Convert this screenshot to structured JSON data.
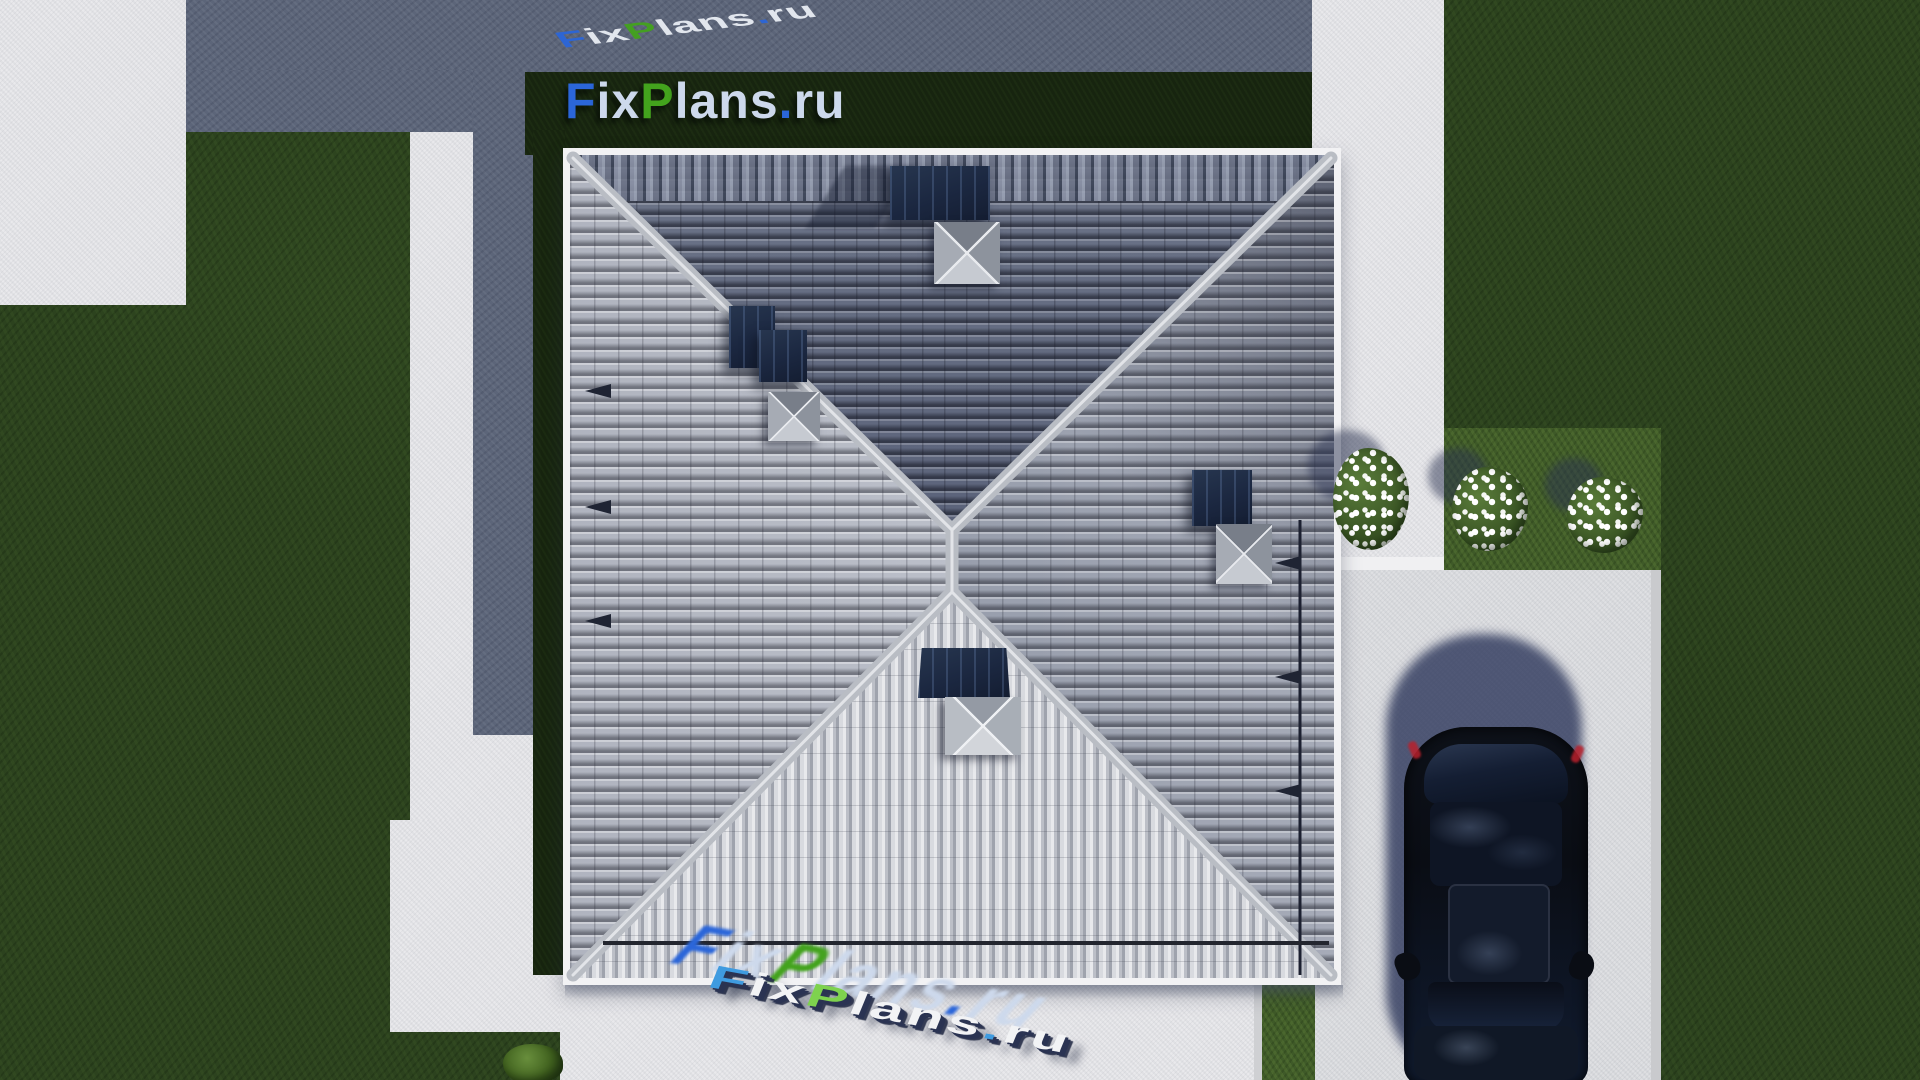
{
  "scene": {
    "description": "Aerial top-down 3D architectural render: hip-roof house with lawn, walkways, driveway, parked car and flower bushes",
    "branding": {
      "site_name": "FixPlans.ru",
      "segments": [
        {
          "text": "F",
          "tone": "blue"
        },
        {
          "text": "ix",
          "tone": "light"
        },
        {
          "text": "P",
          "tone": "green"
        },
        {
          "text": "lans",
          "tone": "light"
        },
        {
          "text": ".",
          "tone": "blue"
        },
        {
          "text": "ru",
          "tone": "light"
        }
      ]
    },
    "watermarks": {
      "top_3d_text": "FixPlans.ru",
      "banner_text": "FixPlans.ru",
      "bottom_3d_text": "FixPlans.ru"
    },
    "palette": {
      "logo_blue": "#2b66d9",
      "logo_green": "#43a31d",
      "logo_light": "#cdd9ec",
      "grass": "#2c421e",
      "grass_bright": "#3f5a28",
      "grass_dark_strip": "#17240f",
      "pavement": "#e9e9ec",
      "driveway": "#dfe0e3",
      "shadow_blue": "#5c6579",
      "roof_ridge": "#b9bdc4",
      "skylight_navy": "#1d2b45",
      "car_body": "#0b101b",
      "car_shadow": "#2e3a5e",
      "flower_white": "#ffffff"
    },
    "objects": {
      "house_roof": "square hip roof, X ridge pattern, gray tiles",
      "car": "dark navy sedan parked on driveway, seen from above",
      "flower_bushes": 3,
      "green_bush": 1
    }
  }
}
